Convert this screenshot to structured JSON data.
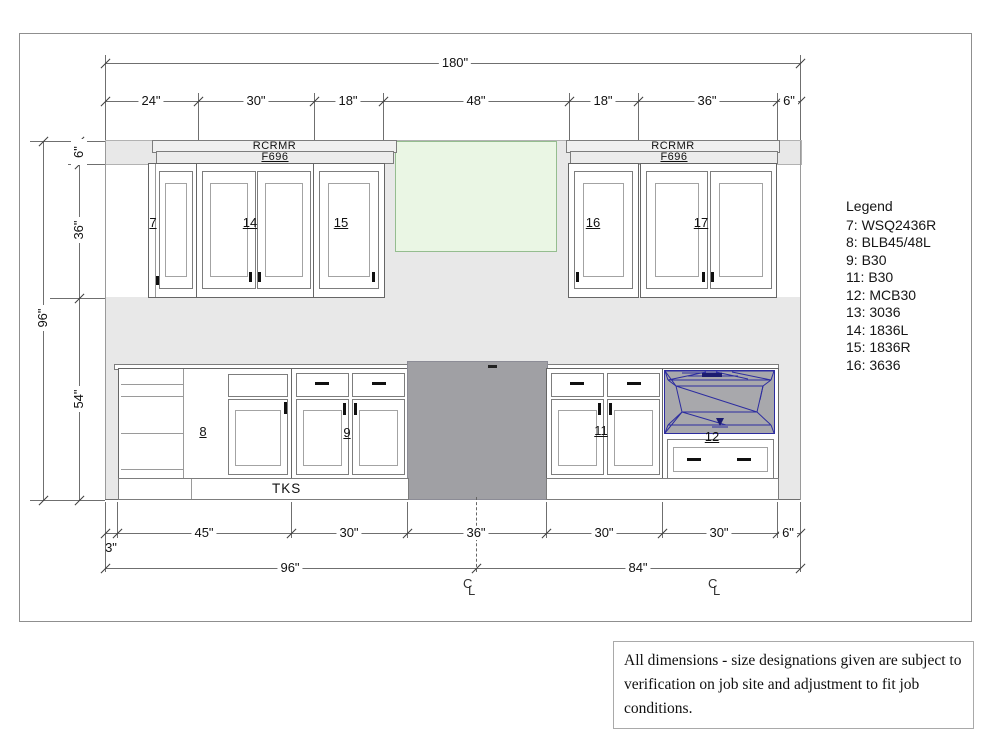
{
  "dimensions": {
    "top_total": "180\"",
    "top_segments": [
      "24\"",
      "30\"",
      "18\"",
      "48\"",
      "18\"",
      "36\"",
      "6\""
    ],
    "left_total": "96\"",
    "left_segments": [
      "6\"",
      "36\"",
      "54\""
    ],
    "bottom_segments": [
      "3\"",
      "45\"",
      "30\"",
      "36\"",
      "30\"",
      "30\"",
      "6\""
    ],
    "bottom_totals": [
      "96\"",
      "84\""
    ]
  },
  "labels": {
    "crown_line1": "RCRMR",
    "crown_line2": "F696",
    "toe_kick": "TKS",
    "centerline_c": "C",
    "centerline_l": "L"
  },
  "cabinets": {
    "c7": "7",
    "c8": "8",
    "c9": "9",
    "c11": "11",
    "c12": "12",
    "c14": "14",
    "c15": "15",
    "c16": "16",
    "c17": "17"
  },
  "legend": {
    "title": "Legend",
    "items": [
      "7: WSQ2436R",
      "8: BLB45/48L",
      "9: B30",
      "11: B30",
      "12: MCB30",
      "13: 3036",
      "14: 1836L",
      "15: 1836R",
      "16: 3636"
    ]
  },
  "note": {
    "text": "All dimensions - size designations given are subject to verification on job site and adjustment to fit job conditions."
  },
  "colors": {
    "wall": "#e8e8e8",
    "window_fill": "#eaf6e4",
    "window_border": "#95bd8f",
    "range": "#a0a0a4",
    "microwave_wire": "#2d2da0"
  }
}
